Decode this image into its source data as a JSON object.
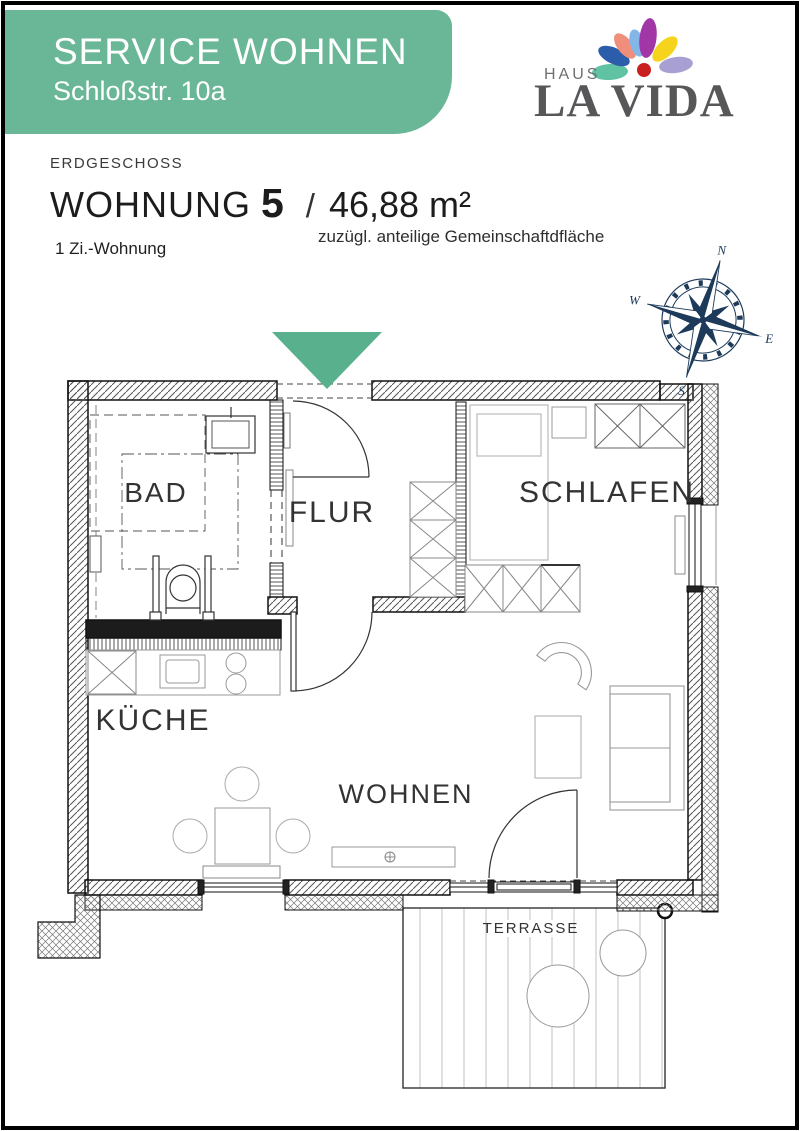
{
  "banner": {
    "title": "SERVICE WOHNEN",
    "subtitle": "Schloßstr. 10a",
    "color": "#69b797"
  },
  "logo": {
    "haus": "HAUS",
    "name": "LA VIDA",
    "name_color": "#57575a",
    "dot_color": "#c92020",
    "petals": [
      {
        "name": "teal",
        "color": "#5fc2a2"
      },
      {
        "name": "dark-blue",
        "color": "#2b5dab"
      },
      {
        "name": "coral",
        "color": "#ef8f7b"
      },
      {
        "name": "light-blue",
        "color": "#84b7e7"
      },
      {
        "name": "purple",
        "color": "#a136a6"
      },
      {
        "name": "yellow",
        "color": "#f6d41e"
      },
      {
        "name": "lavender",
        "color": "#a89fd2"
      }
    ]
  },
  "header": {
    "floor": "ERDGESCHOSS",
    "unit_label": "WOHNUNG",
    "unit_number": "5",
    "separator": "/",
    "area": "46,88 m²",
    "area_note": "zuzügl. anteilige Gemeinschaftdfläche",
    "apartment_type": "1 Zi.-Wohnung"
  },
  "compass": {
    "n": "N",
    "e": "E",
    "s": "S",
    "w": "W",
    "color": "#1d3a5a"
  },
  "floorplan": {
    "arrow_color": "#58b08c",
    "rooms": {
      "bad": "BAD",
      "flur": "FLUR",
      "schlafen": "SCHLAFEN",
      "kueche": "KÜCHE",
      "wohnen": "WOHNEN",
      "terrasse": "TERRASSE"
    }
  }
}
